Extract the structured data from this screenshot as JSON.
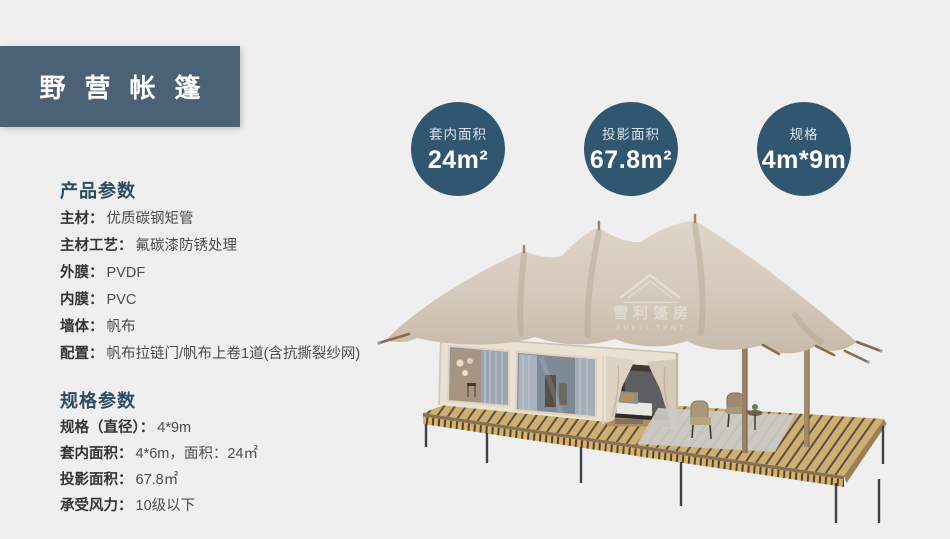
{
  "page": {
    "background": "#efeff0"
  },
  "header": {
    "title": "野营帐篷",
    "bg_color": "#4b6175"
  },
  "badges": {
    "bg_color": "#315670",
    "items": [
      {
        "label": "套内面积",
        "value": "24m²"
      },
      {
        "label": "投影面积",
        "value": "67.8m²"
      },
      {
        "label": "规格",
        "value": "4m*9m"
      }
    ]
  },
  "product_params": {
    "heading": "产品参数",
    "items": [
      {
        "label": "主材：",
        "value": "优质碳钢矩管"
      },
      {
        "label": "主材工艺：",
        "value": "氟碳漆防锈处理"
      },
      {
        "label": "外膜：",
        "value": "PVDF"
      },
      {
        "label": "内膜：",
        "value": "PVC"
      },
      {
        "label": "墙体：",
        "value": "帆布"
      },
      {
        "label": "配置：",
        "value": "帆布拉链门/帆布上卷1道(含抗撕裂纱网)"
      }
    ]
  },
  "spec_params": {
    "heading": "规格参数",
    "items": [
      {
        "label": "规格（直径）：",
        "value": "4*9m"
      },
      {
        "label": "套内面积：",
        "value": "4*6m，面积：24㎡"
      },
      {
        "label": "投影面积：",
        "value": "67.8㎡"
      },
      {
        "label": "承受风力：",
        "value": "10级以下"
      }
    ]
  },
  "tent_image": {
    "watermark_cn": "雪利篷房",
    "watermark_en": "XUELI TENT",
    "canopy_color": "#d5c9bb",
    "cabin_color": "#ebe1d3",
    "deck_color": "#cfae6e",
    "leg_color": "#3d4147"
  }
}
